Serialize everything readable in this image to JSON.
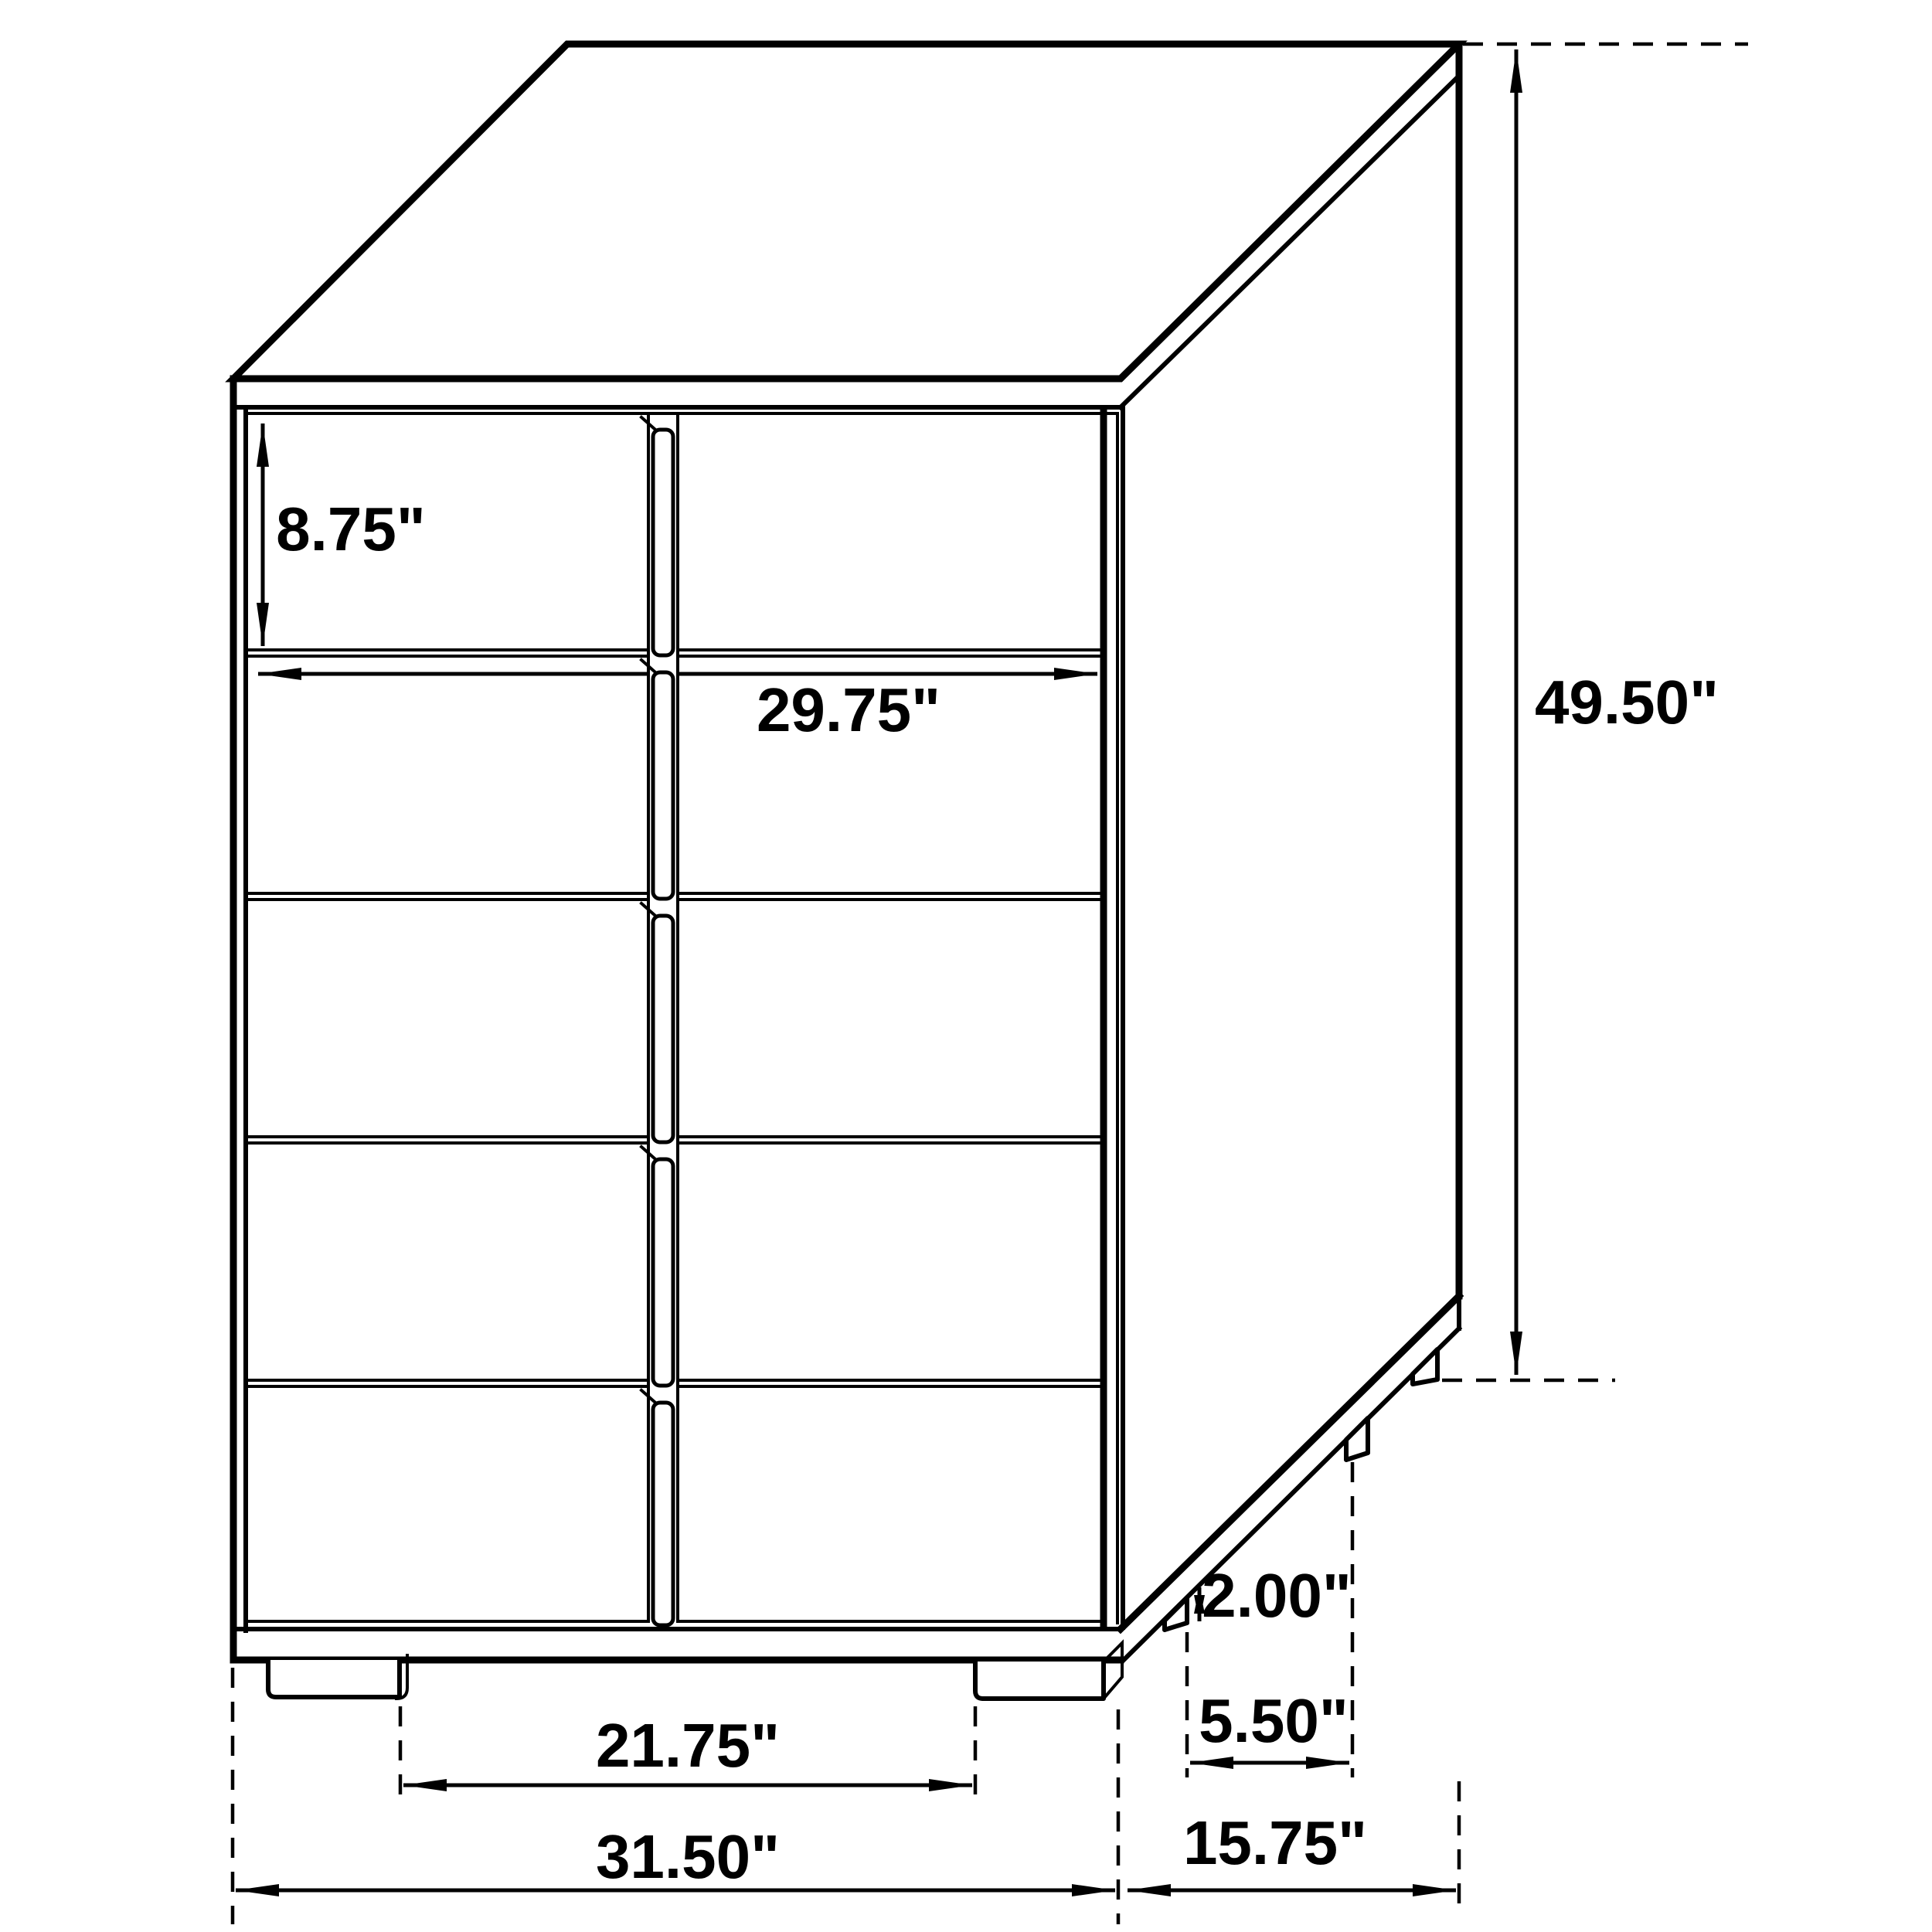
{
  "diagram": {
    "kind": "furniture-dimension-drawing",
    "subject": "five-drawer-chest",
    "background_color": "#ffffff",
    "line_color": "#000000"
  },
  "dimensions": {
    "drawer_height": "8.75\"",
    "drawer_width": "29.75\"",
    "overall_height": "49.50\"",
    "foot_height": "2.00\"",
    "side_feet_spacing": "5.50\"",
    "front_feet_spacing": "21.75\"",
    "overall_width": "31.50\"",
    "overall_depth": "15.75\""
  }
}
